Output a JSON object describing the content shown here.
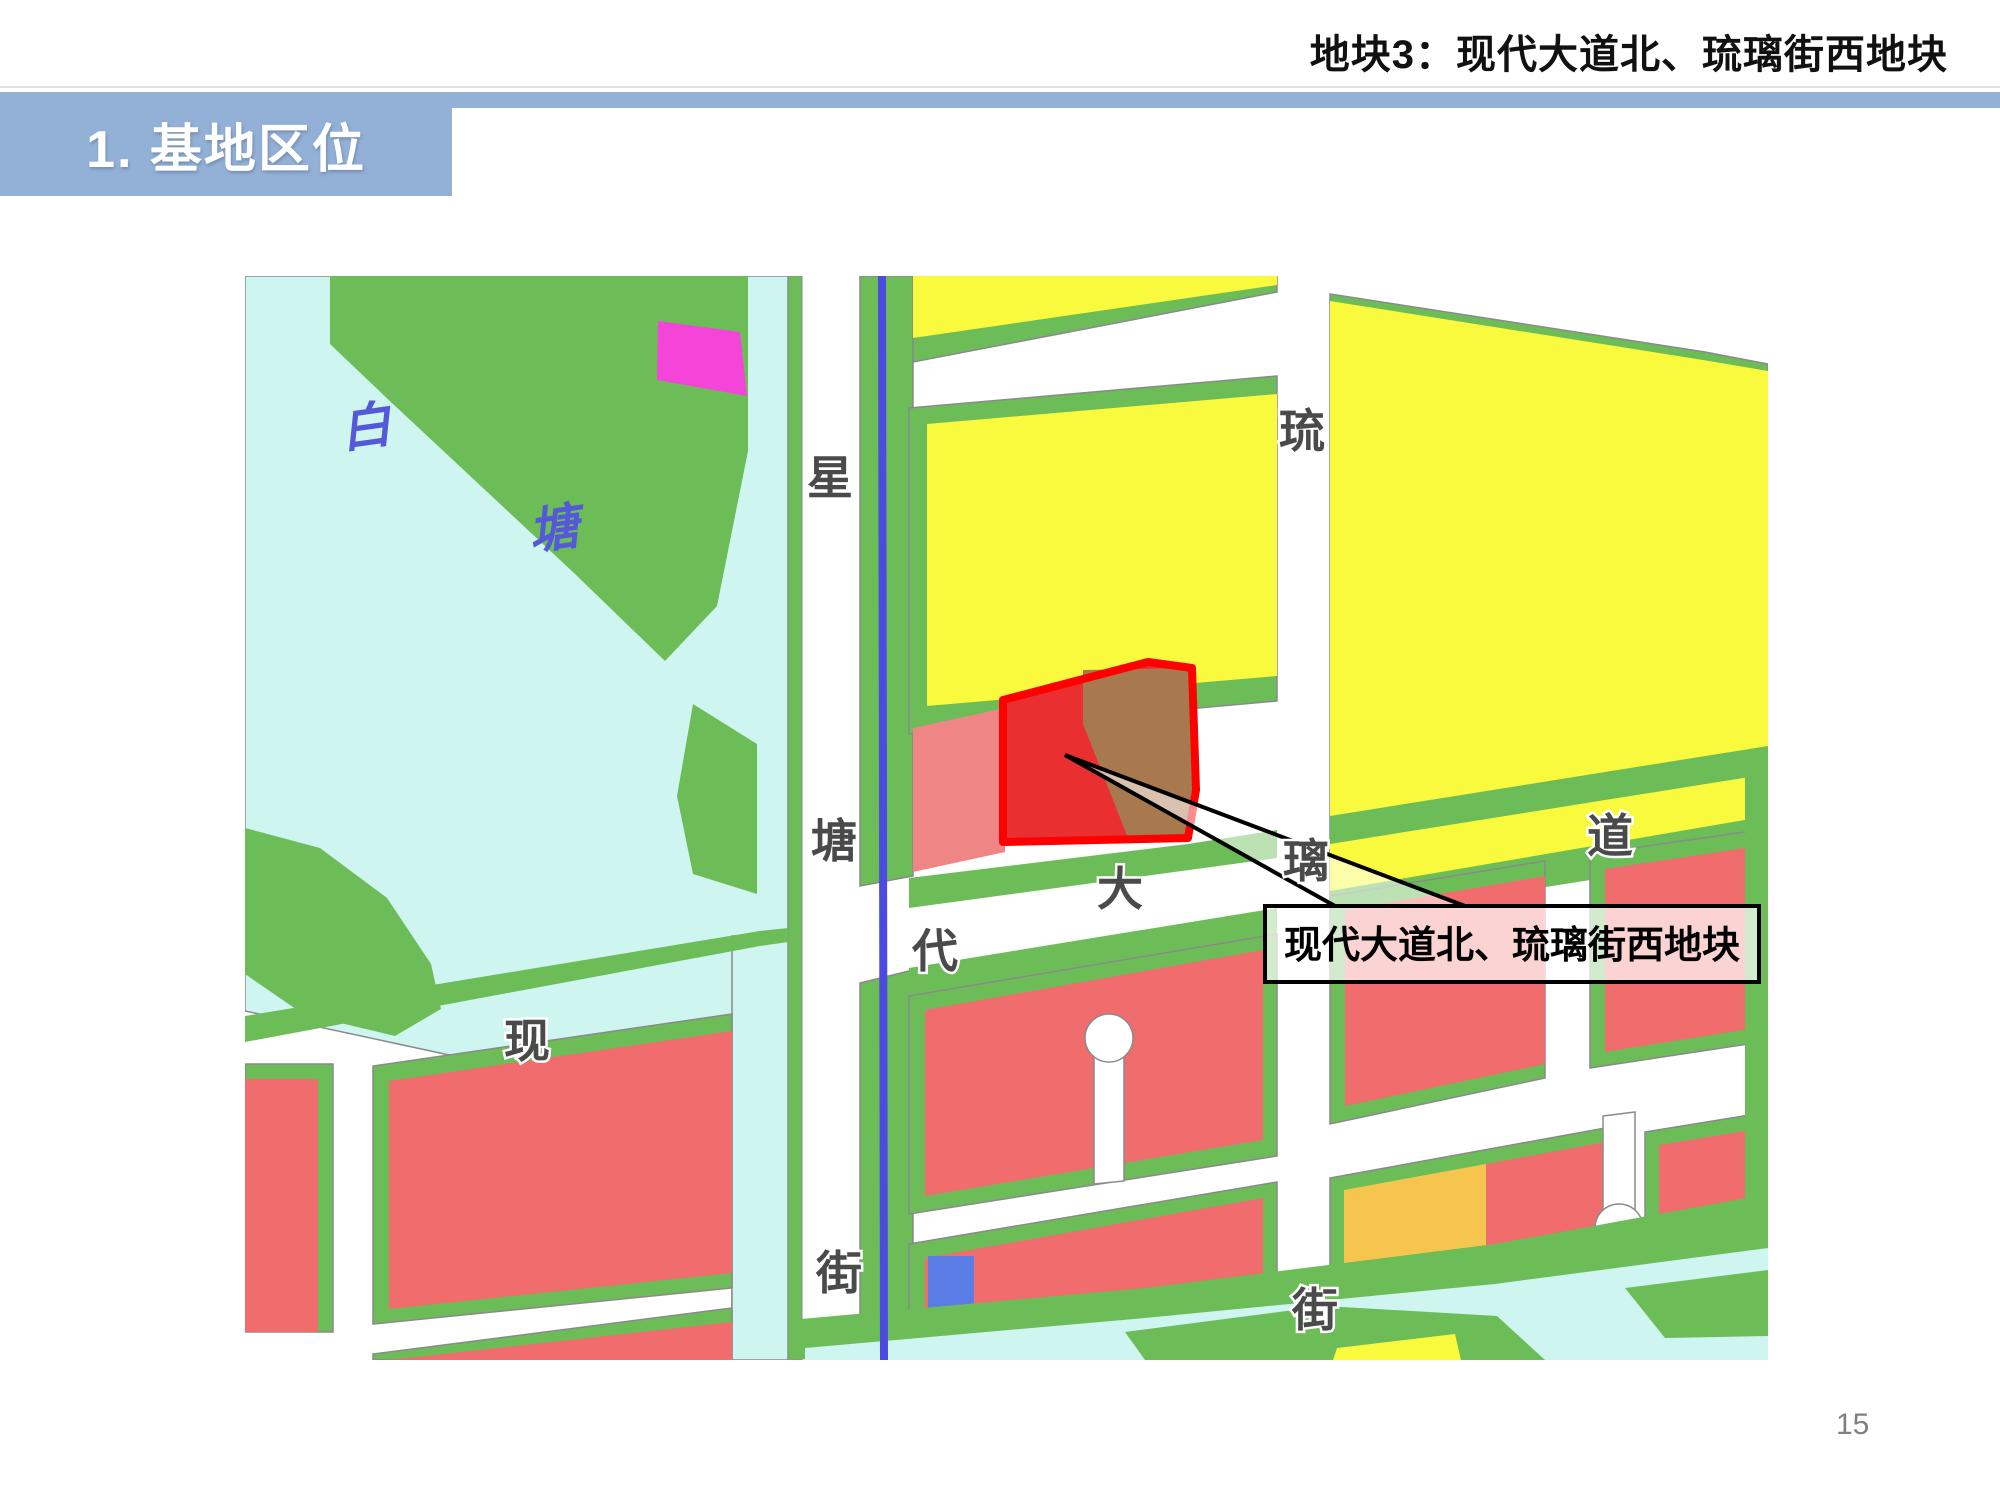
{
  "header": {
    "slide_title": "地块3：现代大道北、琉璃街西地块",
    "section_label": "1. 基地区位"
  },
  "map": {
    "lake_label": {
      "char_bai": "白",
      "char_tang": "塘"
    },
    "streets": {
      "xingtang_street": {
        "char1": "星",
        "char2": "塘",
        "char3": "街"
      },
      "xiandai_avenue": {
        "char1": "现",
        "char2": "代",
        "char3": "大",
        "char4": "道"
      },
      "liuli_street": {
        "char1": "琉",
        "char2": "璃",
        "char3": "街"
      }
    },
    "callout": {
      "label": "现代大道北、琉璃街西地块"
    },
    "legend_colors": {
      "water": "#cff5f0",
      "green_space": "#6cbd58",
      "residential_yellow": "#f9fa3e",
      "commercial_red": "#f16c6c",
      "salmon_block": "#ef8585",
      "parcel_fill": "#e92f2f",
      "parcel_outline": "#ff0000",
      "parcel_brown": "#a8794e",
      "magenta_block": "#f545d8",
      "orange_block": "#f6c54d",
      "blue_block": "#5a7de5",
      "metro_line": "#4b4be0",
      "road": "#ffffff",
      "banner_blue": "#93b1d7"
    }
  },
  "footer": {
    "page_number": "15"
  }
}
